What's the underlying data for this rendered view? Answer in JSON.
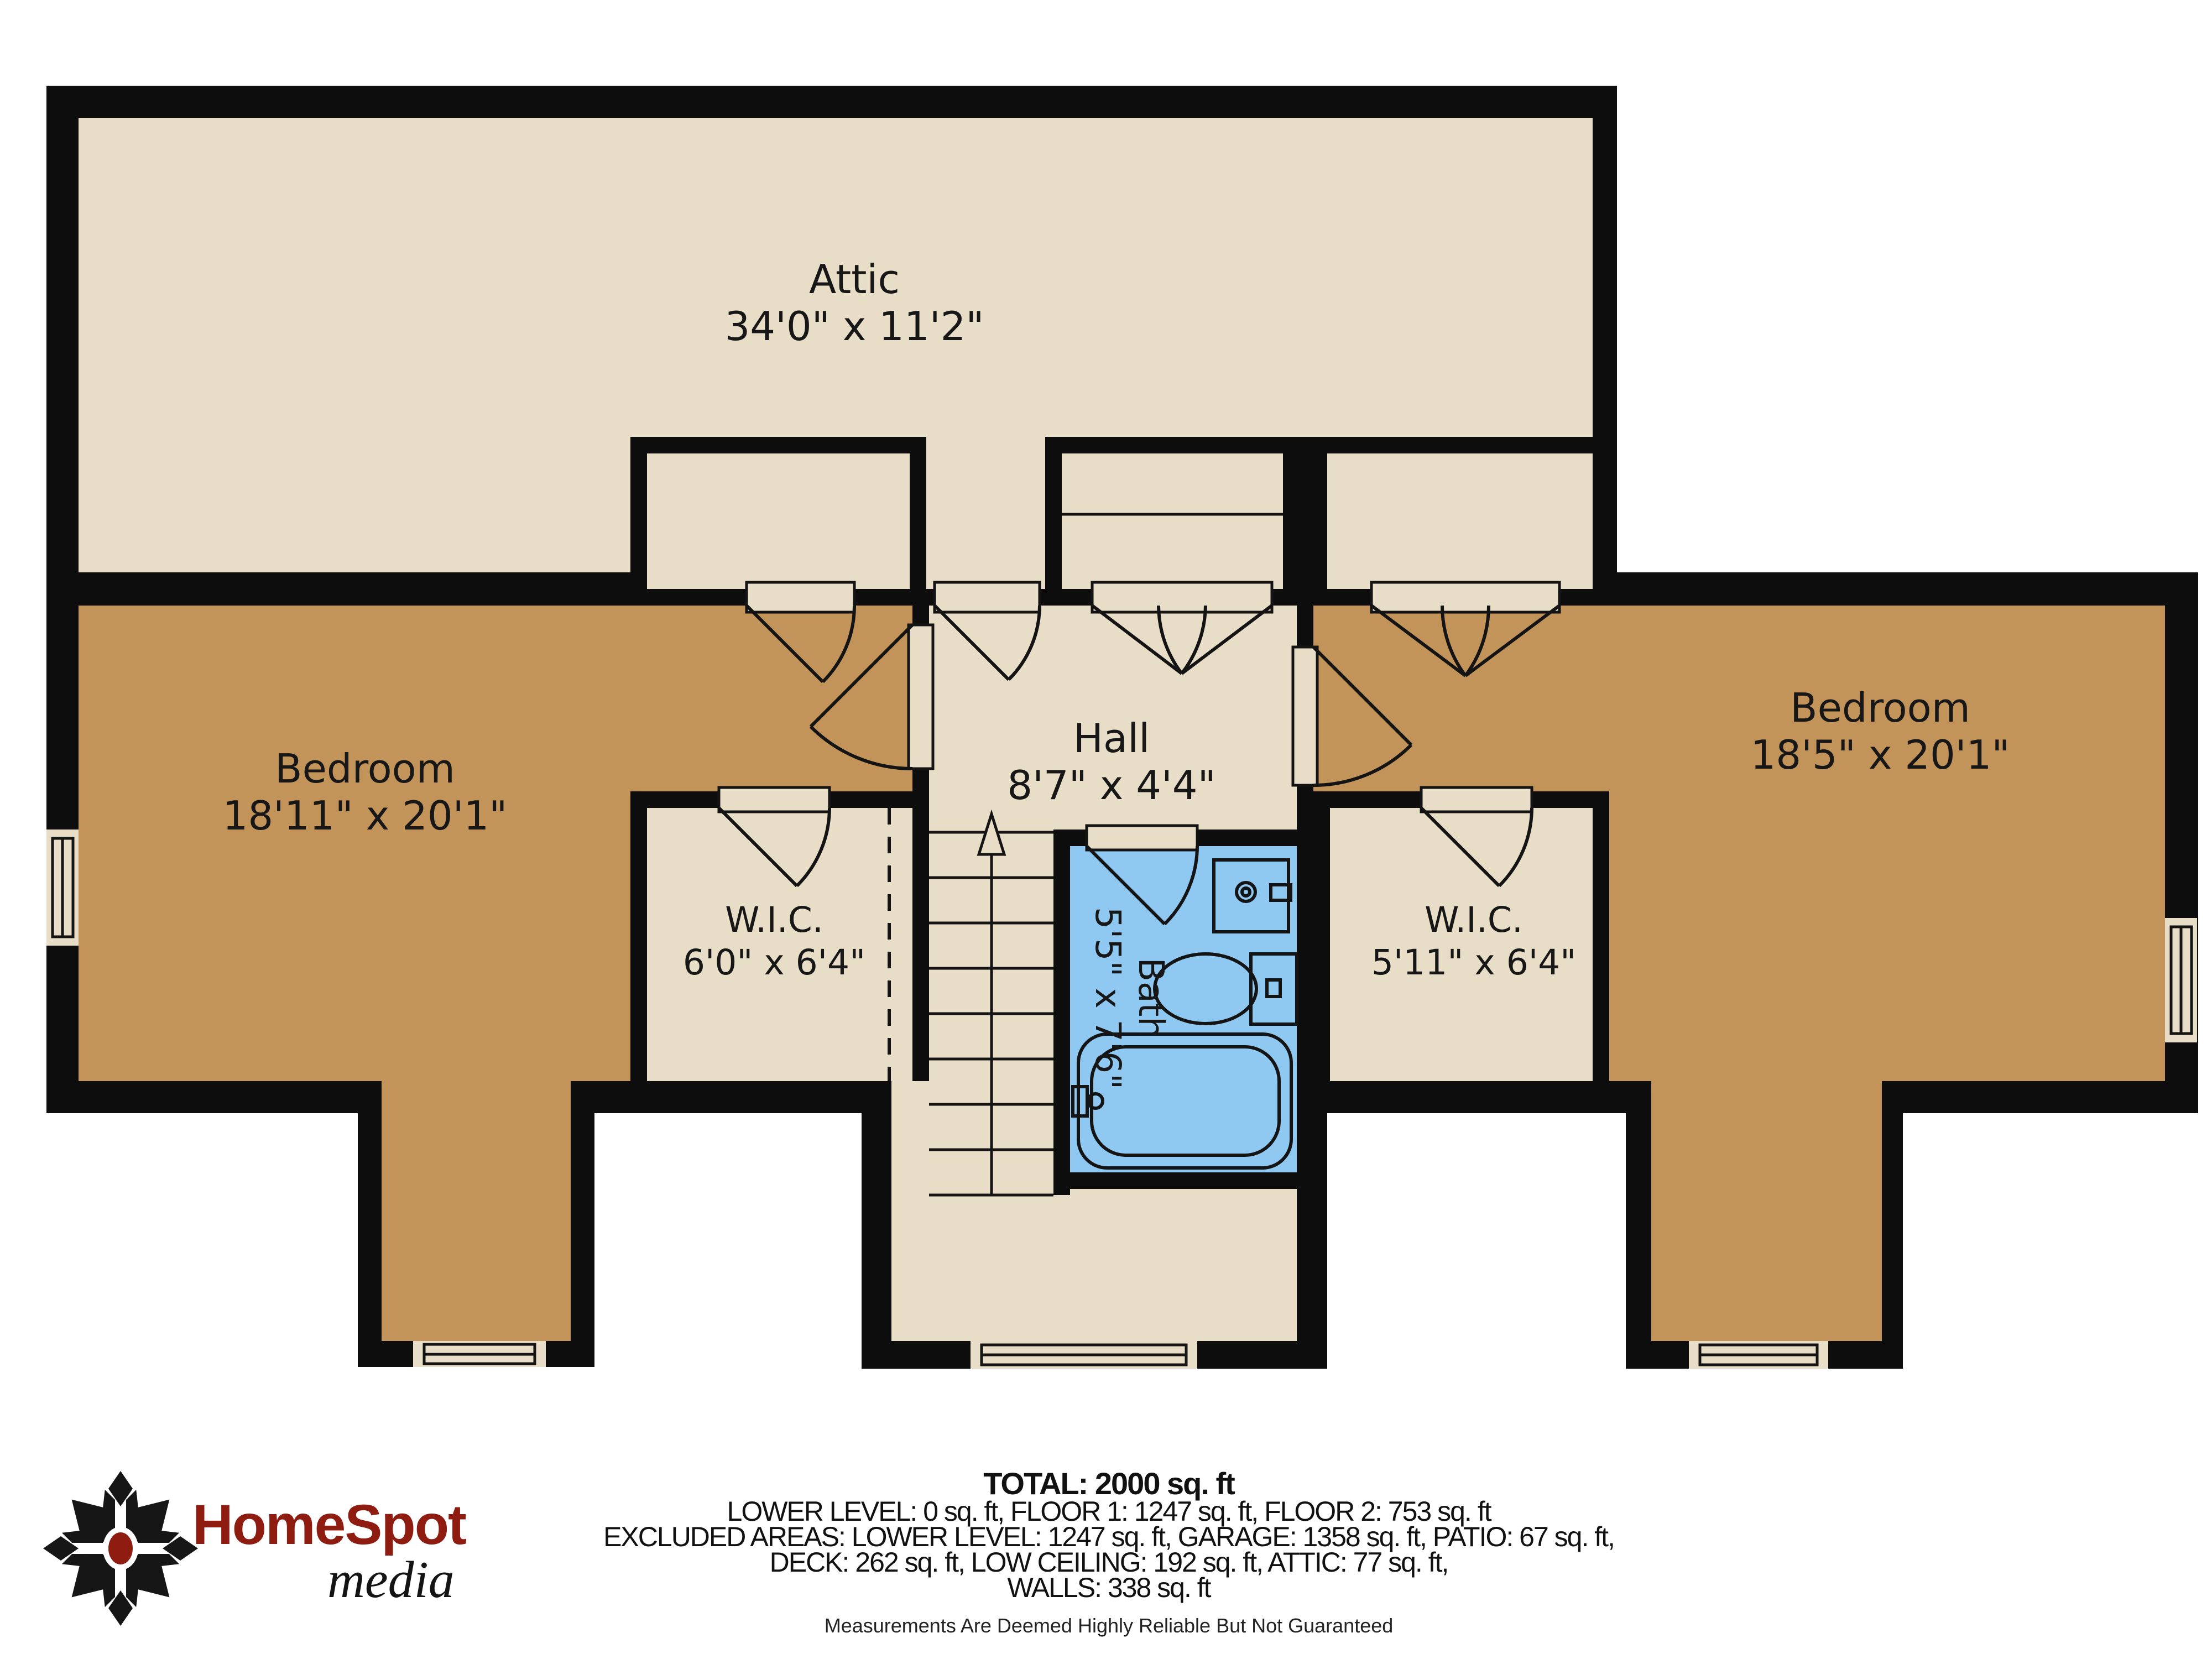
{
  "colors": {
    "cream": "#e8ddc6",
    "tan": "#c3945a",
    "blue": "#8fc9f1",
    "wall": "#0d0d0d",
    "logo_red": "#8e1c10"
  },
  "rooms": {
    "attic": {
      "name": "Attic",
      "dims": "34'0\" x 11'2\""
    },
    "bedroom_left": {
      "name": "Bedroom",
      "dims": "18'11\" x 20'1\""
    },
    "bedroom_right": {
      "name": "Bedroom",
      "dims": "18'5\" x 20'1\""
    },
    "hall": {
      "name": "Hall",
      "dims": "8'7\" x 4'4\""
    },
    "bath": {
      "name": "Bath",
      "dims": "5'5\" x 7'6\""
    },
    "wic_left": {
      "name": "W.I.C.",
      "dims": "6'0\" x 6'4\""
    },
    "wic_right": {
      "name": "W.I.C.",
      "dims": "5'11\" x 6'4\""
    }
  },
  "footer": {
    "lines": [
      "TOTAL: 2000 sq. ft",
      "LOWER LEVEL: 0 sq. ft, FLOOR 1: 1247 sq. ft, FLOOR 2: 753 sq. ft",
      "EXCLUDED AREAS: LOWER LEVEL: 1247 sq. ft, GARAGE: 1358 sq. ft, PATIO: 67 sq. ft,",
      "DECK: 262 sq. ft, LOW CEILING: 192 sq. ft, ATTIC: 77 sq. ft,",
      "WALLS: 338 sq. ft"
    ],
    "disclaimer": "Measurements Are Deemed Highly Reliable But Not Guaranteed"
  },
  "logo": {
    "name": "HomeSpot",
    "sub": "media"
  }
}
